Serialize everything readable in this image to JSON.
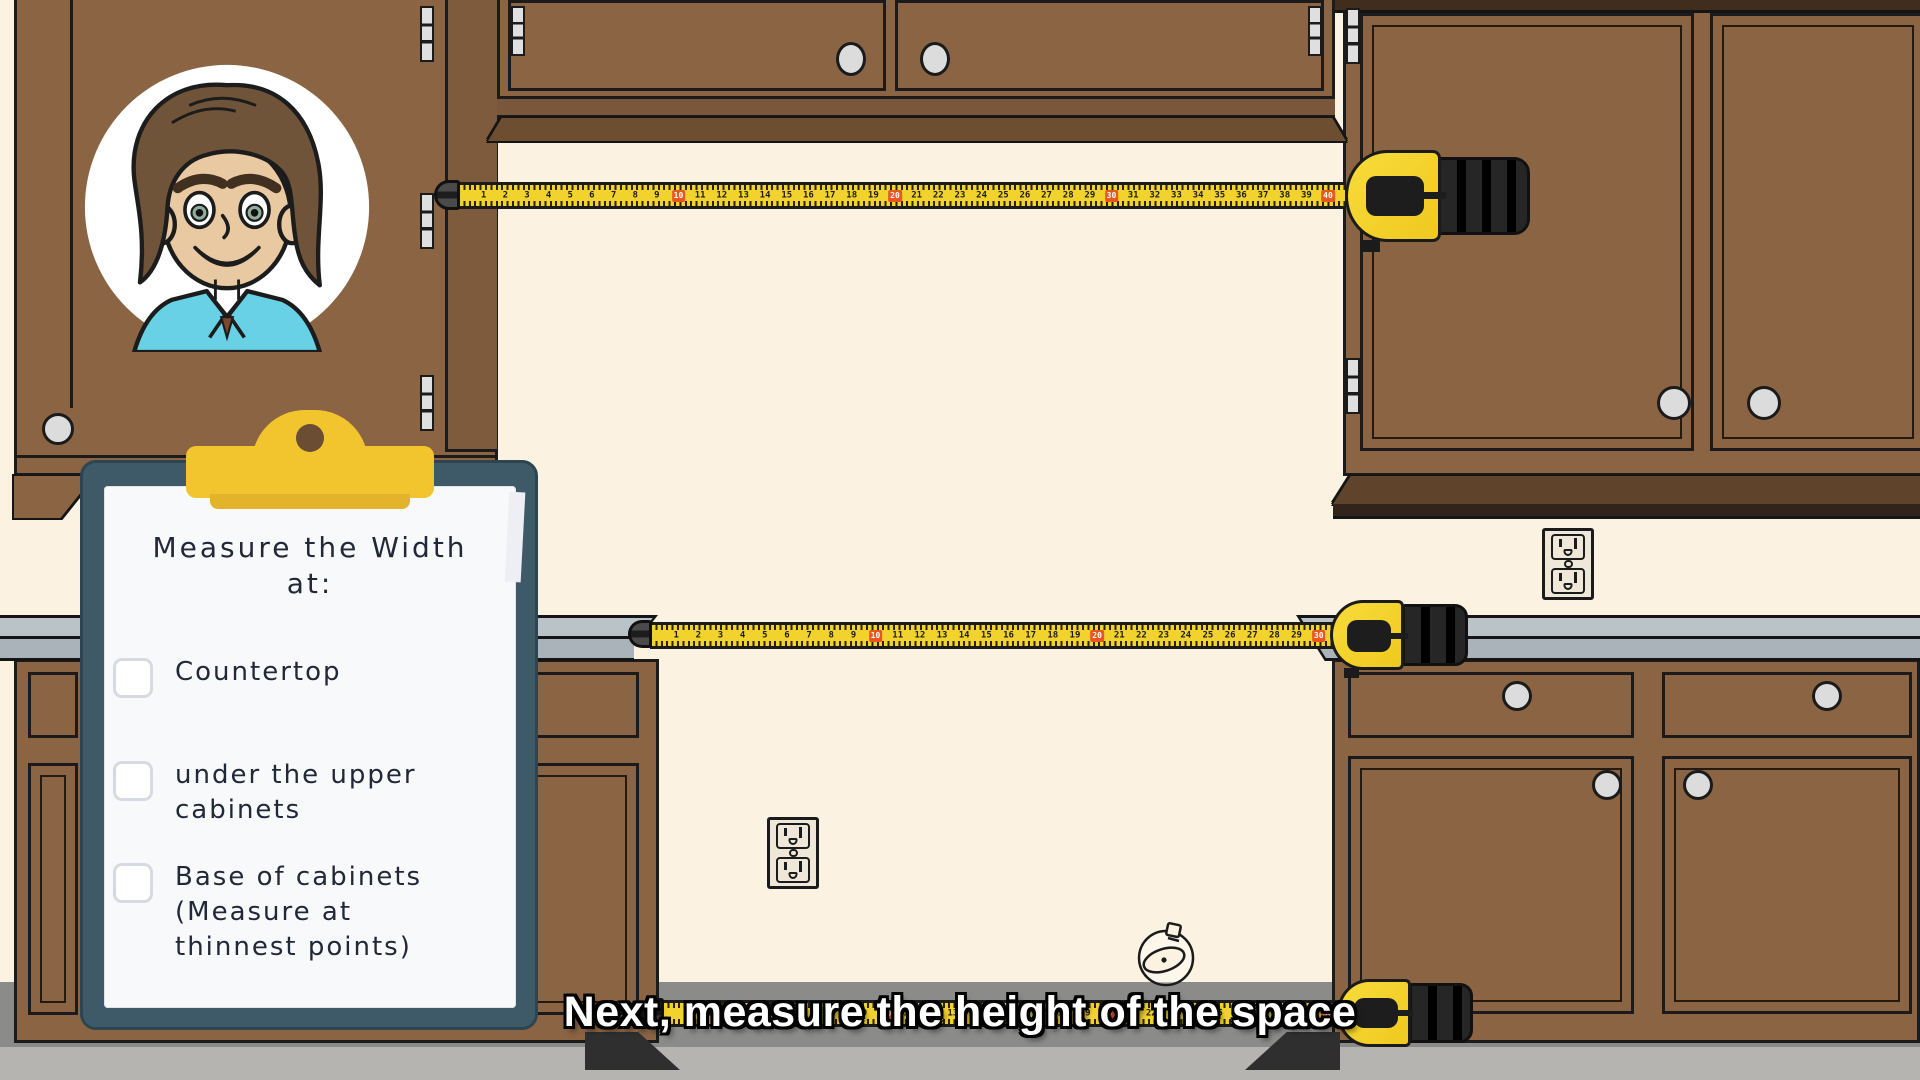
{
  "video": {
    "caption": "Next, measure the height of the space"
  },
  "clipboard": {
    "title": "Measure the Width\nat:",
    "items": [
      {
        "label": "Countertop",
        "checked": false
      },
      {
        "label": "under the upper\ncabinets",
        "checked": false
      },
      {
        "label": " Base of cabinets\n(Measure at\nthinnest points)",
        "checked": false
      }
    ]
  },
  "tapes": [
    {
      "name": "under-upper-cabinets-tape",
      "units": 40,
      "highlight_every": 10
    },
    {
      "name": "countertop-tape",
      "units": 30,
      "highlight_every": 10
    },
    {
      "name": "base-of-cabinets-tape",
      "units": 30,
      "highlight_every": 10
    }
  ],
  "icons": {
    "avatar": "cartoon-man-avatar",
    "watch": "watch-icon",
    "outlets": "power-outlet-icon"
  },
  "colors": {
    "wall_cream": "#FBF2E1",
    "cabinet_brown": "#8A6443",
    "cabinet_trim_dark": "#5C4129",
    "counter_gray": "#AEB8BD",
    "tape_yellow": "#F2D32E",
    "tape_marker_orange": "#E8571F",
    "clipboard_teal": "#3E5A68",
    "clip_yellow": "#F2C52F",
    "floor_dark": "#8B8B89",
    "floor_light": "#B5B4B1",
    "caption_text": "#FFFFFF",
    "shirt_teal": "#69D1E6"
  }
}
